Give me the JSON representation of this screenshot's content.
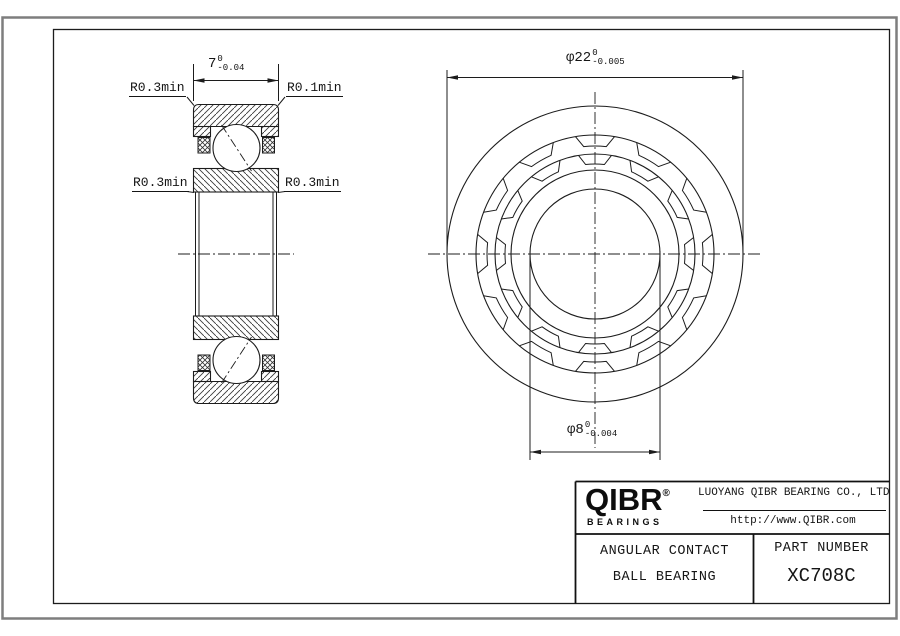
{
  "section_view": {
    "width_dim": {
      "value": "7",
      "tol_upper": "0",
      "tol_lower": "-0.04"
    },
    "fillet_labels": {
      "top_left": "R0.3min",
      "top_right": "R0.1min",
      "mid_left": "R0.3min",
      "mid_right": "R0.3min"
    }
  },
  "front_view": {
    "outer_dia_dim": {
      "value": "φ22",
      "tol_upper": "0",
      "tol_lower": "-0.005"
    },
    "bore_dia_dim": {
      "value": "φ8",
      "tol_upper": "0",
      "tol_lower": "-0.004"
    }
  },
  "title_block": {
    "logo_text": "QIBR",
    "logo_registered": "®",
    "logo_subtext": "BEARINGS",
    "company_name": "LUOYANG QIBR BEARING CO., LTD",
    "website": "http://www.QIBR.com",
    "product_type_line1": "ANGULAR CONTACT",
    "product_type_line2": "BALL BEARING",
    "part_number_label": "PART NUMBER",
    "part_number": "XC708C"
  },
  "colors": {
    "line": "#1c1c1c",
    "outer_border": "#7e7e7e",
    "background": "#ffffff"
  }
}
